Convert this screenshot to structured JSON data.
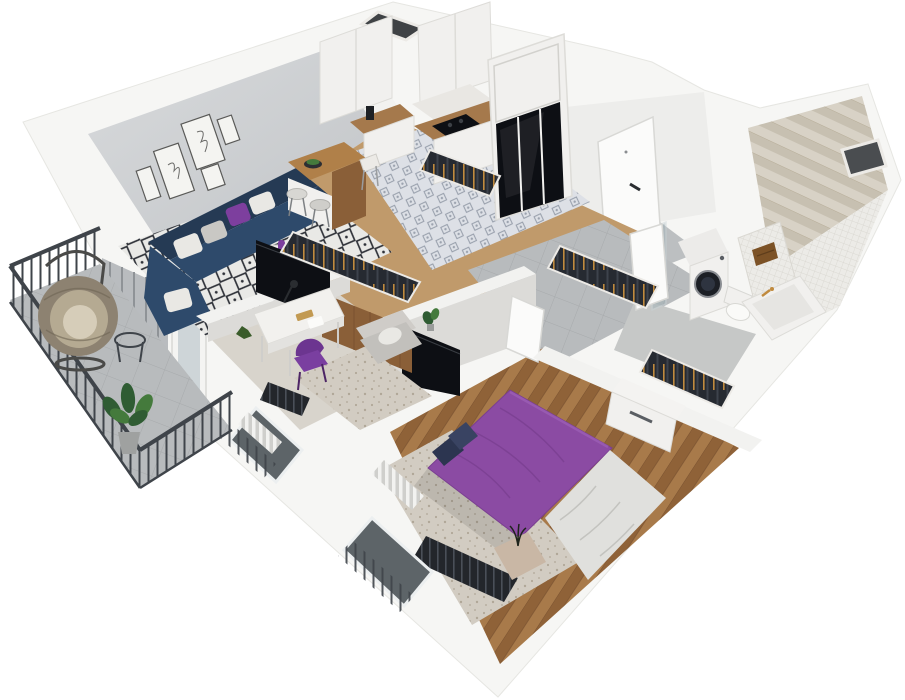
{
  "meta": {
    "alt": "3D isometric cutaway render of a one-bedroom apartment floor plan viewed from above",
    "background": "#ffffff",
    "render_style": "dollhouse-3d"
  },
  "palette": {
    "slabWhite": "#f6f6f4",
    "slabEdge": "#e6e6e2",
    "wallFace": "#c6c9cc",
    "wallFaceLight": "#d7d9db",
    "partitionTop": "#f2f2f0",
    "partitionFace": "#dcdbd8",
    "applianceWhite": "#f1f0ee",
    "floorWood": "#c09a6b",
    "herringWood1": "#a87a4a",
    "herringWood2": "#8f6238",
    "kitchenTileBg": "#dde0e6",
    "kitchenTileFg": "#5b6678",
    "concrete": "#b8bbbd",
    "concreteLine": "#a7aaac",
    "bathFloor": "#c6c8c7",
    "carpet": "#d8d4cc",
    "speckle": "#d2ccc2",
    "speckleDot": "#b0a798",
    "rugBg": "#e9e9e6",
    "rugFg": "#2e3138",
    "sofaNavy": "#2e4a6b",
    "sofaNavyDark": "#253a54",
    "pillowWhite": "#e9e8e4",
    "pillowGray": "#c9c8c4",
    "accentPurple": "#7d3f9e",
    "bedPurple": "#8b4ba3",
    "bedPurpleDark": "#7a3f91",
    "blanketWhite": "#e0e0dd",
    "woodCounter": "#a5794c",
    "woodPanel": "#8a5f38",
    "glossBlack": "#0d0f14",
    "railDark": "#3f444a",
    "glassDark": "#5d6468",
    "tileBeige1": "#d8d2c6",
    "tileBeige2": "#c7c0b1",
    "mosaic": "#ecebe7",
    "mosaicLine": "#d6d4cd",
    "washerDoor": "#1c1f25",
    "towelBrown": "#7c5226",
    "brassGold": "#c08a3e",
    "rattan": "#8d8271",
    "rattanLight": "#b5aa92",
    "cushionBeige": "#d6cdb9",
    "plantGreen": "#2f5c33",
    "plantGreenLight": "#447a3c",
    "chairPurple": "#7a3fa0",
    "hangerDark": "#262a31"
  },
  "scene": {
    "rooms": [
      {
        "name": "living-room",
        "furniture": [
          "corner-sofa",
          "throw-pillows",
          "coffee-table",
          "vase",
          "tv",
          "area-rug",
          "wall-art-frames",
          "bar-island",
          "bar-stools",
          "curtains",
          "balcony-door"
        ]
      },
      {
        "name": "kitchen",
        "furniture": [
          "upper-cabinets",
          "counter",
          "cooktop",
          "coffee-machine",
          "backsplash",
          "tall-wardrobe-black-glass",
          "patterned-tile-floor"
        ]
      },
      {
        "name": "hallway",
        "furniture": [
          "entry-door",
          "open-closet-rails",
          "concrete-floor",
          "potted-plant"
        ]
      },
      {
        "name": "bathroom",
        "furniture": [
          "washing-machine",
          "toilet",
          "bathtub",
          "towel",
          "glass-partition",
          "herringbone-tile-wall",
          "mosaic-tile-wall",
          "duct-shaft"
        ]
      },
      {
        "name": "office",
        "furniture": [
          "desk",
          "desk-lamp",
          "books",
          "toy-figure",
          "purple-chair",
          "armchair",
          "rug",
          "wood-wardrobe-panel",
          "radiator",
          "window"
        ]
      },
      {
        "name": "bedroom",
        "furniture": [
          "double-bed-purple",
          "blanket",
          "pillows",
          "rug",
          "dresser",
          "open-wardrobe-rail",
          "tv-panel",
          "door",
          "window",
          "radiator",
          "pouf",
          "dried-plant"
        ]
      },
      {
        "name": "balcony",
        "furniture": [
          "hanging-egg-chair",
          "side-table",
          "potted-plant",
          "metal-railing",
          "tile-floor"
        ]
      }
    ]
  }
}
